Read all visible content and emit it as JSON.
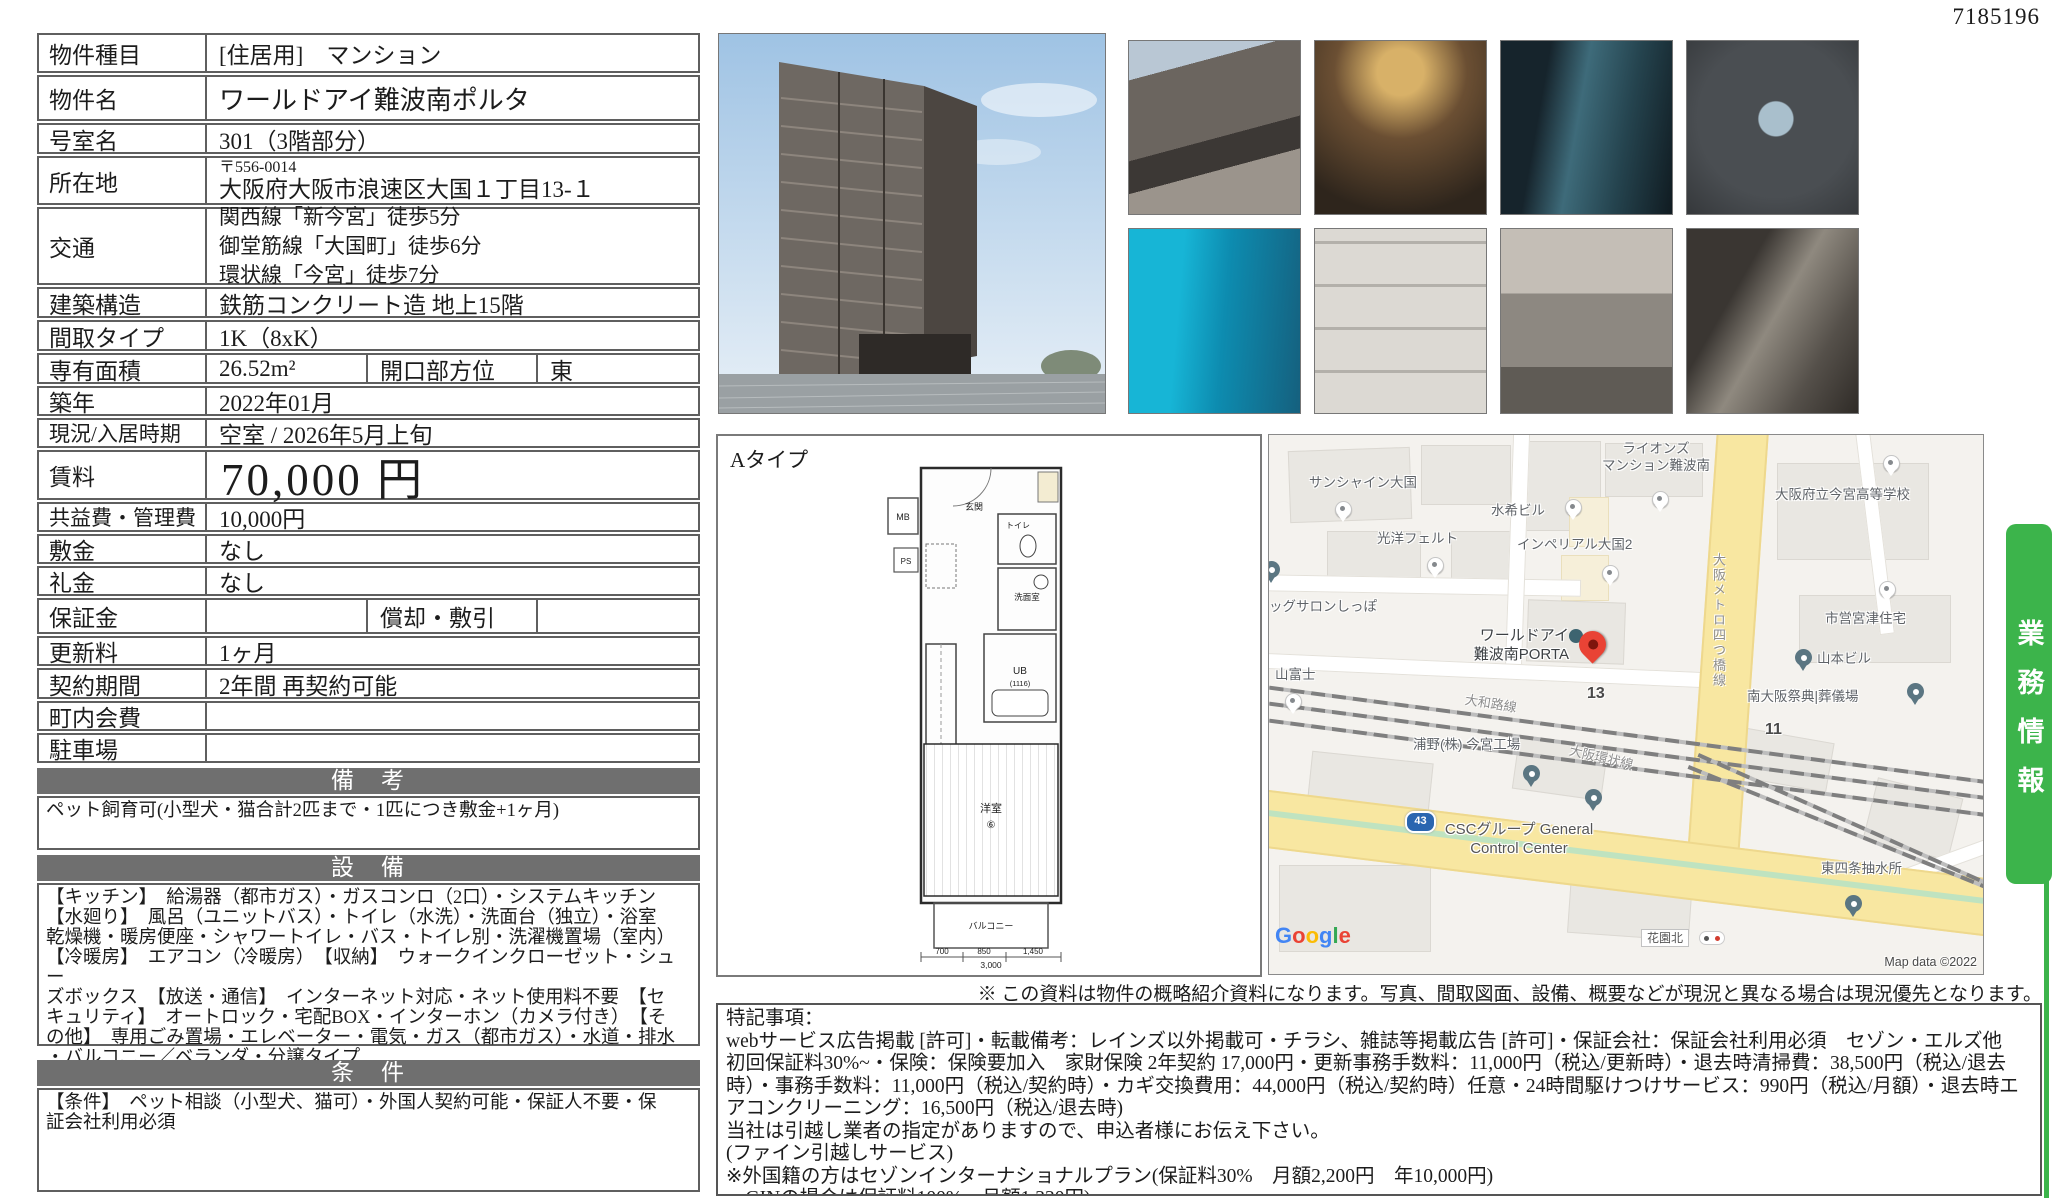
{
  "doc_number": "7185196",
  "banner": {
    "text": "業務情報",
    "color": "#3cb44b"
  },
  "disclaimer": "※ この資料は物件の概略紹介資料になります。写真、間取図面、設備、概要などが現況と異なる場合は現況優先となります。",
  "notes_text": "特記事項：\nwebサービス広告掲載 [許可]・転載備考：レインズ以外掲載可・チラシ、雑誌等掲載広告 [許可]・保証会社：保証会社利用必須　セゾン・エルズ他　初回保証料30%~・保険：保険要加入　家財保険 2年契約 17,000円・更新事務手数料：11,000円（税込/更新時）・退去時清掃費：38,500円（税込/退去時）・事務手数料：11,000円（税込/契約時）・カギ交換費用：44,000円（税込/契約時）任意・24時間駆けつけサービス：990円（税込/月額）・退去時エアコンクリーニング：16,500円（税込/退去時)\n当社は引越し業者の指定がありますので、申込者様にお伝え下さい。\n(ファイン引越しサービス)\n※外国籍の方はセゾンインターナショナルプラン(保証料30%　月額2,200円　年10,000円)\n　GINの場合は保証料100%　月額1,330円)\n解約予告2ヶ月前",
  "table": {
    "rows": [
      {
        "label": "物件種目",
        "value": "[住居用]　マンション"
      },
      {
        "label": "物件名",
        "value": "ワールドアイ難波南ポルタ"
      },
      {
        "label": "号室名",
        "value": "301（3階部分）"
      },
      {
        "label": "所在地",
        "postal": "〒556-0014",
        "value": "大阪府大阪市浪速区大国１丁目13-１"
      },
      {
        "label": "交通",
        "lines": [
          "関西線「新今宮」徒歩5分",
          "御堂筋線「大国町」徒歩6分",
          "環状線「今宮」徒歩7分"
        ]
      },
      {
        "label": "建築構造",
        "value": "鉄筋コンクリート造 地上15階"
      },
      {
        "label": "間取タイプ",
        "value": "1K（8xK）"
      },
      {
        "label": "専有面積",
        "value": "26.52m²",
        "label2": "開口部方位",
        "value2": "東"
      },
      {
        "label": "築年",
        "value": "2022年01月"
      },
      {
        "label": "現況/入居時期",
        "value": "空室 / 2026年5月上旬"
      },
      {
        "label": "賃料",
        "value": "70,000 円"
      },
      {
        "label": "共益費・管理費",
        "value": "10,000円"
      },
      {
        "label": "敷金",
        "value": "なし"
      },
      {
        "label": "礼金",
        "value": "なし"
      },
      {
        "label": "保証金",
        "value": "",
        "label2": "償却・敷引",
        "value2": ""
      },
      {
        "label": "更新料",
        "value": "1ヶ月"
      },
      {
        "label": "契約期間",
        "value": "2年間 再契約可能"
      },
      {
        "label": "町内会費",
        "value": ""
      },
      {
        "label": "駐車場",
        "value": ""
      }
    ],
    "sections": [
      {
        "header": "備　考",
        "text": "ペット飼育可(小型犬・猫合計2匹まで・1匹につき敷金+1ヶ月)"
      },
      {
        "header": "設　備",
        "text": "【キッチン】　給湯器（都市ガス）・ガスコンロ（2口）・システムキッチン\n【水廻り】　風呂（ユニットバス）・トイレ（水洗）・洗面台（独立）・浴室\n乾燥機・暖房便座・シャワートイレ・バス・トイレ別・洗濯機置場（室内）\n【冷暖房】　エアコン（冷暖房）　【収納】　ウォークインクローゼット・シュー\nズボックス　【放送・通信】　インターネット対応・ネット使用料不要　【セ\nキュリティ】　オートロック・宅配BOX・インターホン（カメラ付き）　【そ\nの他】　専用ごみ置場・エレベーター・電気・ガス（都市ガス）・水道・排水\n・バルコニー／ベランダ・分譲タイプ"
      },
      {
        "header": "条　件",
        "text": "【条件】　ペット相談（小型犬、猫可）・外国人契約可能・保証人不要・保\n証会社利用必須"
      }
    ]
  },
  "floorplan": {
    "type_label": "Aタイプ",
    "labels": {
      "mb": "MB",
      "ps": "PS",
      "entrance": "玄関",
      "toilet": "トイレ",
      "washroom": "洗面室",
      "ub": "UB",
      "ub_size": "(1116)",
      "room": "洋室",
      "room_num": "⑥",
      "balcony": "バルコニー"
    },
    "dimensions": {
      "d1": "700",
      "d2": "850",
      "d3": "1,450",
      "total": "3,000"
    }
  },
  "map": {
    "attribution": "Map data ©2022",
    "google_letters": [
      "G",
      "o",
      "o",
      "g",
      "l",
      "e"
    ],
    "bus_stop": "花園北",
    "route_shield": "43",
    "subject_number": "13",
    "block_number": "11",
    "rail_label_yamatoji": "大和路線",
    "rail_label_kanjo": "大阪環状線",
    "rail_label_metro": "大阪メトロ四つ橋線",
    "places": [
      {
        "name": "サンシャイン大国"
      },
      {
        "name": "光洋フェルト"
      },
      {
        "name": "水希ビル"
      },
      {
        "name": "インペリアル大国2"
      },
      {
        "name": "ライオンズ\nマンション難波南"
      },
      {
        "name": "大阪府立今宮高等学校"
      },
      {
        "name": "市営宮津住宅"
      },
      {
        "name": "ッグサロンしっぽ"
      },
      {
        "name": "山富士"
      },
      {
        "name": "山本ビル"
      },
      {
        "name": "南大阪祭典|葬儀場"
      },
      {
        "name": "浦野(株) 今宮工場"
      },
      {
        "name": "CSCグループ General\nControl Center"
      },
      {
        "name": "東四条抽水所"
      },
      {
        "name": "ワールドアイ\n難波南PORTA"
      }
    ]
  }
}
